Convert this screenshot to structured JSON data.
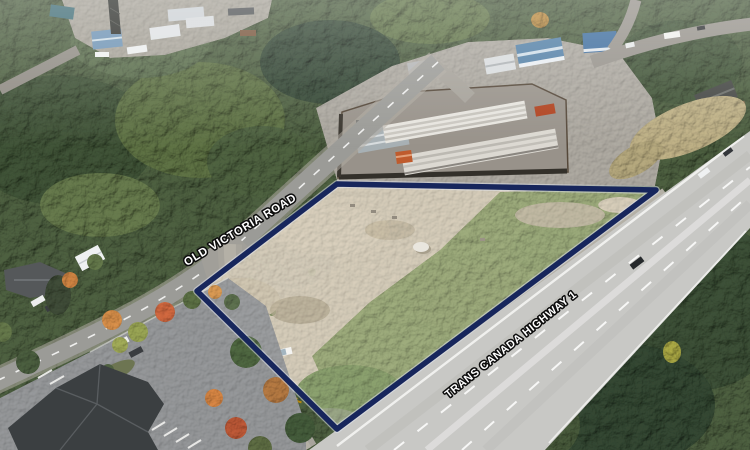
{
  "photo": {
    "kind": "oblique aerial drone photograph of a vacant land parcel beside a highway",
    "palette": {
      "boundary": "#17265c",
      "boundary_halo": "#e3e8f2",
      "label_fill": "#ffffff",
      "label_outline": "#0d0d0d",
      "parcel_dirt": "#c9c0ad",
      "forest": "#46573a",
      "highway_asphalt": "#c8c8c5"
    }
  },
  "labels": {
    "road_west": "OLD VICTORIA ROAD",
    "highway": "TRANS CANADA HIGHWAY 1"
  }
}
